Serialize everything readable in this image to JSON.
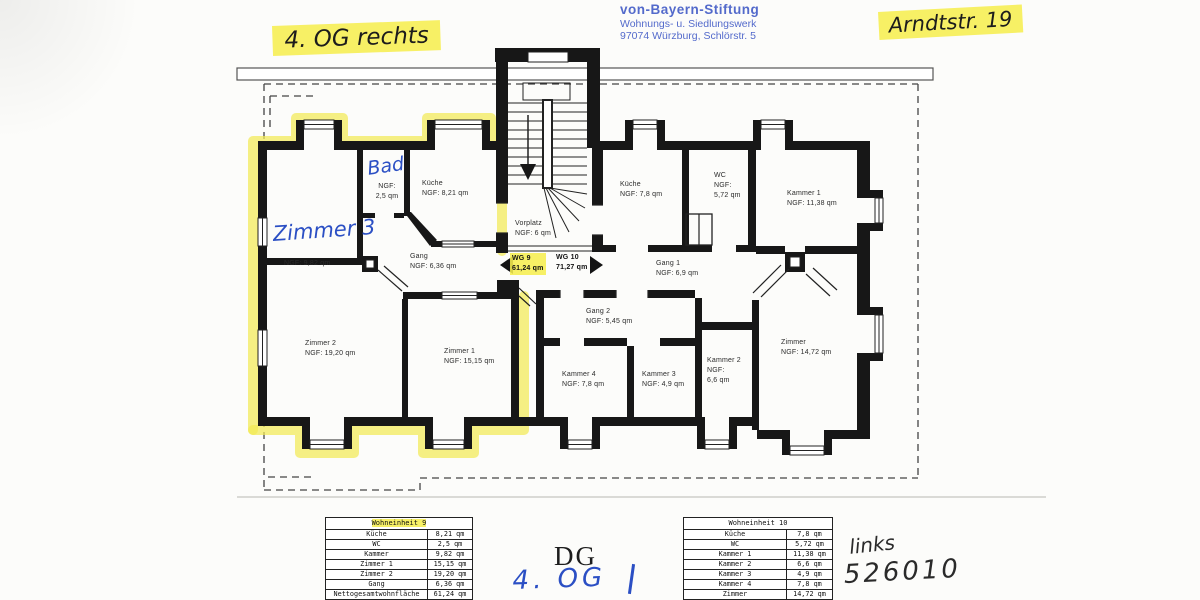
{
  "colors": {
    "highlight": "#f4ec55",
    "stamp_blue": "#4a63c9",
    "pen_blue": "#2b4fc4",
    "ink": "#1c1c1c",
    "wall": "#171717"
  },
  "annotations": {
    "top_left_note": "4. OG rechts",
    "top_right_note": "Arndtstr. 19",
    "floor_label": "DG",
    "floor_note": "4. OG",
    "side_note": "links",
    "number_note": "526010"
  },
  "stamp": {
    "line1": "von-Bayern-Stiftung",
    "line2": "Wohnungs- u. Siedlungswerk",
    "line3": "97074 Würzburg, Schlörstr. 5"
  },
  "plan": {
    "wg9_label": "WG 9\n61,24 qm",
    "wg10_label": "WG 10\n71,27 qm",
    "rooms": {
      "zimmer3_hand": "Zimmer 3",
      "zimmer3_ngf": "NGF: 9,82 qm",
      "bad_hand": "Bad",
      "bad_ngf": "NGF:\n2,5 qm",
      "kueche9": "Küche\nNGF: 8,21 qm",
      "gang9": "Gang\nNGF: 6,36 qm",
      "vorplatz": "Vorplatz\nNGF: 6 qm",
      "zimmer2": "Zimmer 2\nNGF: 19,20 qm",
      "zimmer1": "Zimmer 1\nNGF: 15,15 qm",
      "kueche10": "Küche\nNGF: 7,8 qm",
      "wc10": "WC\nNGF:\n5,72 qm",
      "kammer1": "Kammer 1\nNGF: 11,38 qm",
      "gang1": "Gang 1\nNGF: 6,9 qm",
      "gang2": "Gang 2\nNGF: 5,45 qm",
      "kammer4": "Kammer 4\nNGF: 7,8 qm",
      "kammer3": "Kammer 3\nNGF: 4,9 qm",
      "kammer2": "Kammer 2\nNGF:\n6,6 qm",
      "zimmer10": "Zimmer\nNGF: 14,72 qm"
    }
  },
  "tables": [
    {
      "title": "Wohneinheit 9",
      "rows": [
        [
          "Küche",
          "8,21 qm"
        ],
        [
          "WC",
          "2,5 qm"
        ],
        [
          "Kammer",
          "9,82 qm"
        ],
        [
          "Zimmer 1",
          "15,15 qm"
        ],
        [
          "Zimmer 2",
          "19,20 qm"
        ],
        [
          "Gang",
          "6,36 qm"
        ],
        [
          "Nettogesamtwohnfläche",
          "61,24 qm"
        ]
      ]
    },
    {
      "title": "Wohneinheit 10",
      "rows": [
        [
          "Küche",
          "7,8 qm"
        ],
        [
          "WC",
          "5,72 qm"
        ],
        [
          "Kammer 1",
          "11,38 qm"
        ],
        [
          "Kammer 2",
          "6,6 qm"
        ],
        [
          "Kammer 3",
          "4,9 qm"
        ],
        [
          "Kammer 4",
          "7,8 qm"
        ],
        [
          "Zimmer",
          "14,72 qm"
        ],
        [
          "",
          ""
        ]
      ]
    }
  ]
}
